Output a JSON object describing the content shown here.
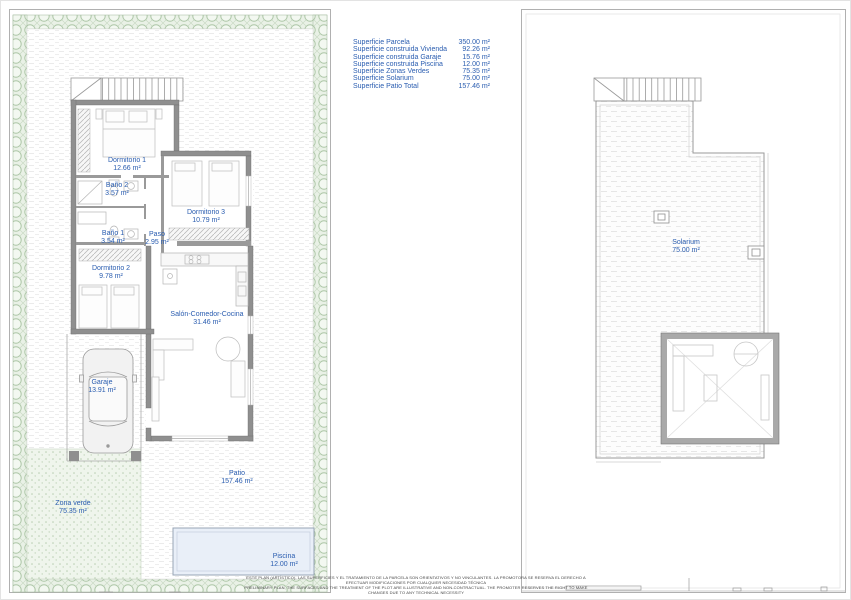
{
  "surface_table": {
    "rows": [
      {
        "label": "Superficie Parcela",
        "value": "350.00 m²"
      },
      {
        "label": "Superficie construida Vivienda",
        "value": "92.26 m²"
      },
      {
        "label": "Superficie construida Garaje",
        "value": "15.76 m²"
      },
      {
        "label": "Superficie construida Piscina",
        "value": "12.00 m²"
      },
      {
        "label": "Superficie Zonas Verdes",
        "value": "75.35 m²"
      },
      {
        "label": "Superficie Solarium",
        "value": "75.00 m²"
      },
      {
        "label": "Superficie Patio Total",
        "value": "157.46 m²"
      }
    ]
  },
  "ground_floor": {
    "rooms": [
      {
        "name": "Dormitorio 1",
        "area": "12.66 m²"
      },
      {
        "name": "Baño 2",
        "area": "3.57 m²"
      },
      {
        "name": "Dormitorio 3",
        "area": "10.79 m²"
      },
      {
        "name": "Baño 1",
        "area": "3.54 m²"
      },
      {
        "name": "Paso",
        "area": "2.95 m²"
      },
      {
        "name": "Dormitorio 2",
        "area": "9.78 m²"
      },
      {
        "name": "Salón-Comedor-Cocina",
        "area": "31.46 m²"
      },
      {
        "name": "Garaje",
        "area": "13.91 m²"
      },
      {
        "name": "Patio",
        "area": "157.46 m²"
      },
      {
        "name": "Zona verde",
        "area": "75.35 m²"
      },
      {
        "name": "Piscina",
        "area": "12.00 m²"
      }
    ]
  },
  "roof": {
    "rooms": [
      {
        "name": "Solarium",
        "area": "75.00 m²"
      }
    ]
  },
  "disclaimer": {
    "line1": "ESTE PLAN (ARTÍSTICO), LAS SUPERFICIES Y EL TRATAMIENTO DE LA PARCELA SON ORIENTATIVOS Y NO VINCULANTES. LA PROMOTORA SE RESERVA EL DERECHO A EFECTUAR MODIFICACIONES POR CUALQUIER NECESIDAD TÉCNICA",
    "line2": "PRELIMINARY PLAN, THE SURFACES AND THE TREATMENT OF THE PLOT ARE ILLUSTRATIVE AND NON-CONTRACTUAL. THE PROMOTER RESERVES THE RIGHT TO MAKE CHANGES DUE TO ANY TECHNICAL NECESSITY"
  },
  "colors": {
    "label_blue": "#2a5db0",
    "wall_gray": "#8f8f8f",
    "hedge_green": "#aec7a8",
    "pool_fill": "#e9eff8"
  }
}
